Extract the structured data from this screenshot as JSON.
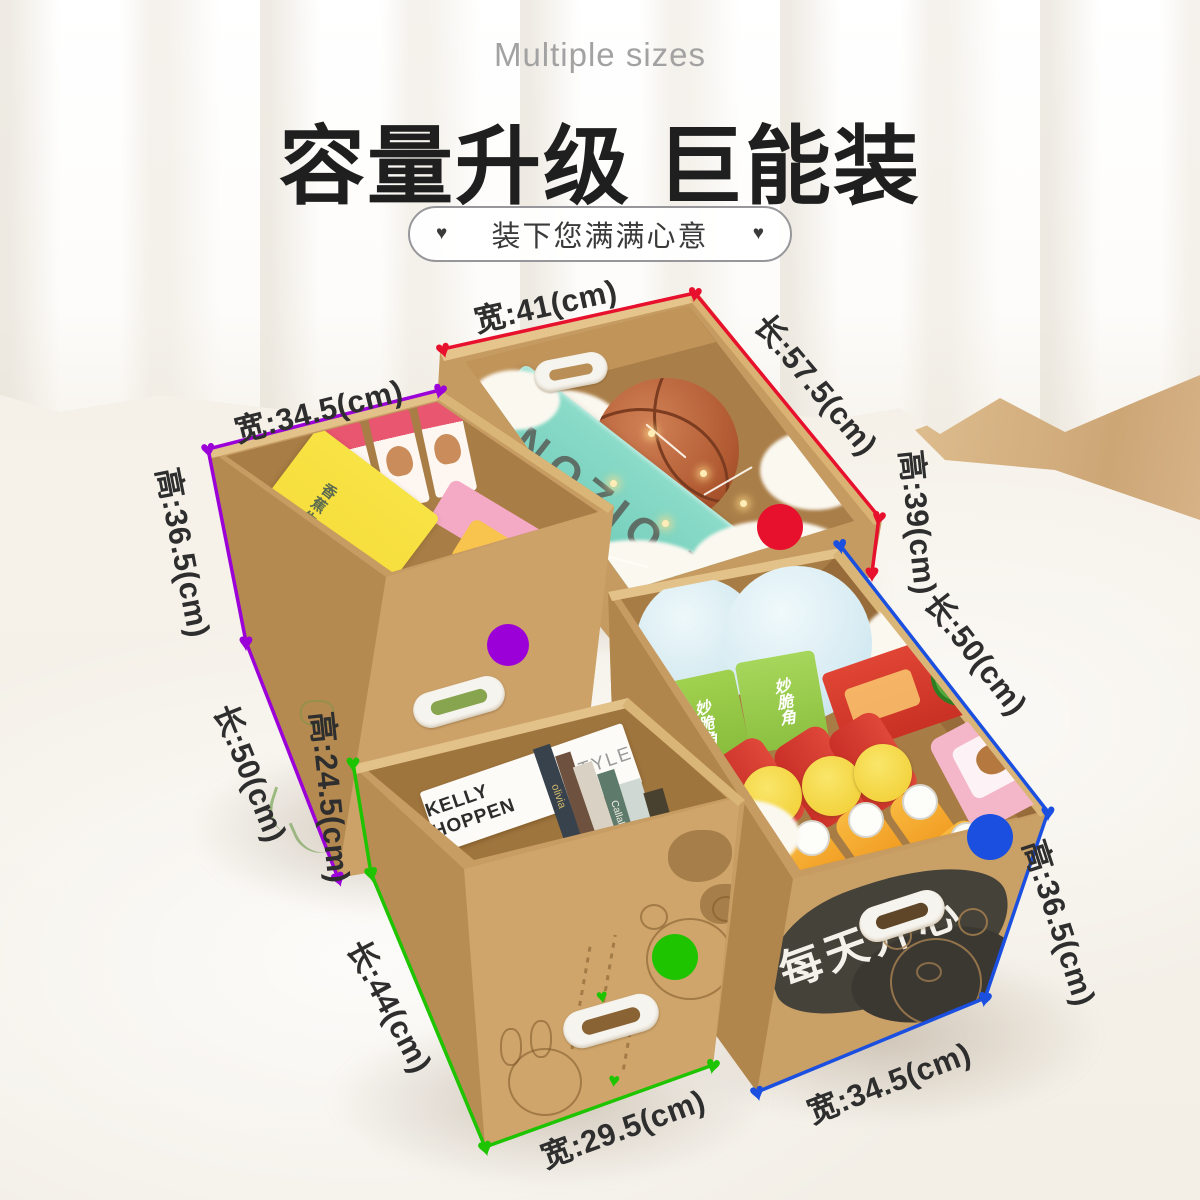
{
  "header": {
    "subtitle": "Multiple sizes",
    "title": "容量升级 巨能装",
    "tagline": "装下您满满心意"
  },
  "icons": {
    "heart": "♥"
  },
  "palette": {
    "red": "#e8112d",
    "purple": "#9b00d8",
    "green": "#1ec400",
    "blue": "#1a4fe0",
    "cardboard": "#c79c63",
    "label_text": "#2e2e2e"
  },
  "dimensions": {
    "red_box": {
      "width": "宽:41(cm)",
      "length": "长:57.5(cm)",
      "height": "高:39(cm)"
    },
    "purple_box": {
      "width": "宽:34.5(cm)",
      "height": "高:36.5(cm)",
      "length": "长:50(cm)"
    },
    "green_box": {
      "height": "高:24.5(cm)",
      "length": "长:44(cm)",
      "width": "宽:29.5(cm)"
    },
    "blue_box": {
      "length": "长:50(cm)",
      "height": "高:36.5(cm)",
      "width": "宽:34.5(cm)"
    }
  },
  "products": {
    "poizon": "POIZON",
    "banana_cake": "香蕉牛奶味蛋糕",
    "crisp_cone": "妙脆角",
    "lays": "Lay's乐事",
    "happy_text": "每天开心",
    "book_main": "KELLY HOPPEN",
    "book_sub": "STYLE",
    "book_back_1": "YEAH HOTELS",
    "book_back_2": "BOOK09",
    "spine_1": "olivia",
    "spine_2": "Callalilia"
  }
}
